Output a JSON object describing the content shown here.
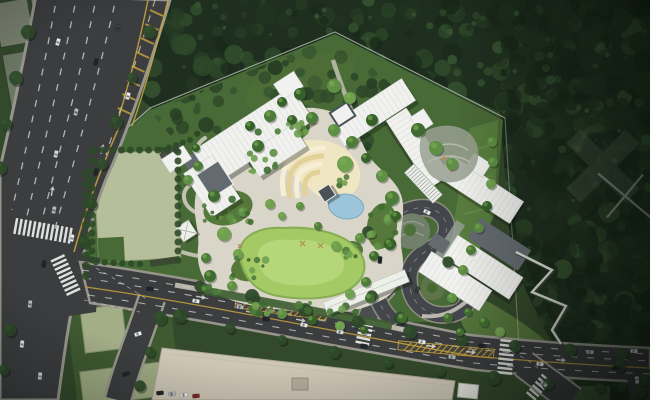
{
  "scene": {
    "type": "aerial-architectural-site-plan-rendering",
    "elements": [
      "forest-canopy",
      "curved-avenue",
      "boulevard",
      "intersection",
      "site-boundary",
      "campus-buildings",
      "central-garden",
      "lawn",
      "amphitheater-terraces",
      "garden-pavilion",
      "pond",
      "loop-driveway",
      "entrance-canopy",
      "sports-field",
      "terraced-garden",
      "stairway-path",
      "existing-rooftop",
      "parcel-pads",
      "crosswalks",
      "street-trees",
      "cars"
    ]
  },
  "palette": {
    "grass-dark": "#33492b",
    "forest-base": "#1e2f1f",
    "forest-1": "#19291a",
    "forest-2": "#213420",
    "forest-3": "#273d25",
    "forest-4": "#2e4829",
    "forest-5": "#365430",
    "forest-6": "#426339",
    "grass-site": "#486a36",
    "grass-slope": "#5c8040",
    "slope-streak": "#6f9450",
    "lawn": "#a3ca65",
    "lawn-light": "#bcdb82",
    "lawn-edge": "#86ad53",
    "paving": "#d9d5c9",
    "paving-light": "#cfccc0",
    "sidewalk": "#b0aea2",
    "asphalt": "#3b3d3f",
    "asphalt-light": "#4b4d4f",
    "curb": "#98968c",
    "lane-white": "#e8e8e6",
    "white-line": "#eceeea",
    "lane-yellow": "#c8a53e",
    "roof-white": "#f1f2ef",
    "roof-ridge": "#d6d8d3",
    "roof-gray": "#646b70",
    "roof-dark": "#4a5258",
    "canopy-white": "#edefe9",
    "field": "#b5bf9a",
    "pad-sage": "#aeb790",
    "parcel-green": "#3f5a31",
    "verge-green": "#44623a",
    "hedge-dark": "#2e4a28",
    "tree-street": "#2f4a2a",
    "pond": "#9cc4da",
    "pond-edge": "#7aa8c0",
    "amph-cream": "#f0e6c2",
    "amph-band": "#e2d198",
    "amph-band-light": "#f6efd6",
    "beige-roof": "#cdc6b6",
    "pad-gray": "#79816f",
    "island-terrace": "#70806a",
    "island-green": "#4e7038",
    "garden-stone": "#99a091",
    "wall-light": "#a8ab9f",
    "boundary": "#cdd4c6",
    "accent-orange": "#cf8a3e",
    "car-1": "#e9eaea",
    "car-2": "#23272b",
    "car-3": "#b7babd",
    "car-4": "#d8d9d9",
    "car-5": "#3a3f44",
    "car-6": "#8a2f2a"
  }
}
